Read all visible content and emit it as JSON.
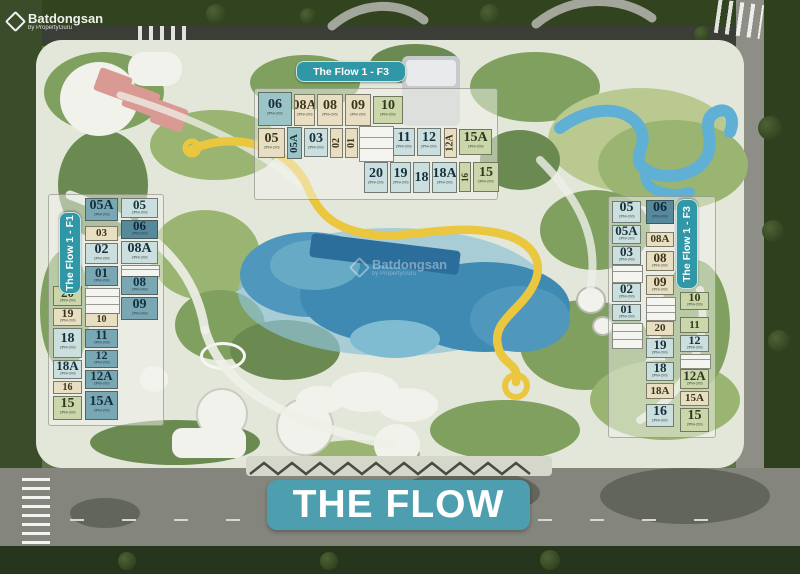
{
  "watermark": {
    "brand": "Batdongsan",
    "subtitle": "by PropertyGuru"
  },
  "banner": {
    "label": "THE FLOW"
  },
  "building_labels": {
    "top": "The Flow 1 - F3",
    "left": "The Flow 1 - F1",
    "right": "The Flow 1 - F3"
  },
  "unit_sub": "2PN+2VS",
  "colors": {
    "banner_bg": "#4d9fb0",
    "pill_bg": "#2f97a6",
    "unit_teal_dark": "#57899d",
    "unit_teal_mid": "#7aa7b4",
    "unit_teal": "#9cc3c6",
    "unit_teal_light": "#cadfde",
    "unit_cream": "#e8dfc2",
    "unit_sage": "#cbd7aa",
    "pool_blue": "#3f8ab2",
    "ribbon_yellow": "#eac73e"
  },
  "units": {
    "top": [
      {
        "n": "06",
        "x": 258,
        "y": 92,
        "w": 34,
        "h": 34,
        "c": "tl"
      },
      {
        "n": "08A",
        "x": 294,
        "y": 94,
        "w": 21,
        "h": 32,
        "c": "cr"
      },
      {
        "n": "08",
        "x": 317,
        "y": 94,
        "w": 26,
        "h": 32,
        "c": "cr"
      },
      {
        "n": "09",
        "x": 345,
        "y": 94,
        "w": 26,
        "h": 32,
        "c": "cr"
      },
      {
        "n": "10",
        "x": 373,
        "y": 96,
        "w": 30,
        "h": 28,
        "c": "sg"
      },
      {
        "n": "05",
        "x": 258,
        "y": 128,
        "w": 27,
        "h": 30,
        "c": "cr"
      },
      {
        "n": "05A",
        "x": 287,
        "y": 127,
        "w": 15,
        "h": 32,
        "c": "tl",
        "v": true
      },
      {
        "n": "03",
        "x": 304,
        "y": 128,
        "w": 24,
        "h": 29,
        "c": "lt"
      },
      {
        "n": "02",
        "x": 330,
        "y": 128,
        "w": 13,
        "h": 30,
        "c": "cr",
        "v": true
      },
      {
        "n": "01",
        "x": 345,
        "y": 128,
        "w": 13,
        "h": 30,
        "c": "cr",
        "v": true
      },
      {
        "n": "11",
        "x": 393,
        "y": 128,
        "w": 22,
        "h": 28,
        "c": "lt"
      },
      {
        "n": "12",
        "x": 417,
        "y": 128,
        "w": 24,
        "h": 28,
        "c": "lt"
      },
      {
        "n": "12A",
        "x": 444,
        "y": 128,
        "w": 13,
        "h": 30,
        "c": "cr",
        "v": true
      },
      {
        "n": "15A",
        "x": 459,
        "y": 129,
        "w": 33,
        "h": 26,
        "c": "sg"
      },
      {
        "n": "20",
        "x": 364,
        "y": 162,
        "w": 24,
        "h": 31,
        "c": "lt"
      },
      {
        "n": "19",
        "x": 390,
        "y": 162,
        "w": 21,
        "h": 31,
        "c": "lt"
      },
      {
        "n": "18",
        "x": 413,
        "y": 162,
        "w": 17,
        "h": 31,
        "c": "lt"
      },
      {
        "n": "18A",
        "x": 432,
        "y": 162,
        "w": 25,
        "h": 31,
        "c": "lt"
      },
      {
        "n": "16",
        "x": 459,
        "y": 162,
        "w": 12,
        "h": 30,
        "c": "sg",
        "v": true
      },
      {
        "n": "15",
        "x": 473,
        "y": 162,
        "w": 26,
        "h": 30,
        "c": "sg"
      }
    ],
    "left": [
      {
        "n": "20",
        "x": 53,
        "y": 286,
        "w": 29,
        "h": 20,
        "c": "sg"
      },
      {
        "n": "19",
        "x": 53,
        "y": 308,
        "w": 29,
        "h": 18,
        "c": "cr"
      },
      {
        "n": "18",
        "x": 53,
        "y": 328,
        "w": 29,
        "h": 30,
        "c": "lt"
      },
      {
        "n": "18A",
        "x": 53,
        "y": 360,
        "w": 29,
        "h": 19,
        "c": "lt"
      },
      {
        "n": "16",
        "x": 53,
        "y": 381,
        "w": 29,
        "h": 13,
        "c": "cr"
      },
      {
        "n": "15",
        "x": 53,
        "y": 396,
        "w": 29,
        "h": 24,
        "c": "sg"
      },
      {
        "n": "05A",
        "x": 85,
        "y": 198,
        "w": 33,
        "h": 23,
        "c": "t2"
      },
      {
        "n": "03",
        "x": 85,
        "y": 226,
        "w": 33,
        "h": 15,
        "c": "cr"
      },
      {
        "n": "02",
        "x": 85,
        "y": 243,
        "w": 33,
        "h": 21,
        "c": "lt"
      },
      {
        "n": "01",
        "x": 85,
        "y": 266,
        "w": 33,
        "h": 20,
        "c": "t2"
      },
      {
        "n": "10",
        "x": 85,
        "y": 313,
        "w": 33,
        "h": 14,
        "c": "cr"
      },
      {
        "n": "11",
        "x": 85,
        "y": 329,
        "w": 33,
        "h": 19,
        "c": "t2"
      },
      {
        "n": "12",
        "x": 85,
        "y": 350,
        "w": 33,
        "h": 18,
        "c": "t2"
      },
      {
        "n": "12A",
        "x": 85,
        "y": 370,
        "w": 33,
        "h": 19,
        "c": "t2"
      },
      {
        "n": "15A",
        "x": 85,
        "y": 391,
        "w": 33,
        "h": 29,
        "c": "t2"
      },
      {
        "n": "05",
        "x": 121,
        "y": 198,
        "w": 37,
        "h": 20,
        "c": "lt"
      },
      {
        "n": "06",
        "x": 121,
        "y": 220,
        "w": 37,
        "h": 19,
        "c": "dk"
      },
      {
        "n": "08A",
        "x": 121,
        "y": 241,
        "w": 37,
        "h": 23,
        "c": "lt"
      },
      {
        "n": "08",
        "x": 121,
        "y": 276,
        "w": 37,
        "h": 19,
        "c": "t2"
      },
      {
        "n": "09",
        "x": 121,
        "y": 297,
        "w": 37,
        "h": 23,
        "c": "t2"
      }
    ],
    "right": [
      {
        "n": "05",
        "x": 612,
        "y": 201,
        "w": 29,
        "h": 22,
        "c": "lt"
      },
      {
        "n": "05A",
        "x": 612,
        "y": 225,
        "w": 29,
        "h": 19,
        "c": "lt"
      },
      {
        "n": "03",
        "x": 612,
        "y": 246,
        "w": 29,
        "h": 19,
        "c": "lt"
      },
      {
        "n": "02",
        "x": 612,
        "y": 283,
        "w": 29,
        "h": 19,
        "c": "lt"
      },
      {
        "n": "01",
        "x": 612,
        "y": 304,
        "w": 29,
        "h": 17,
        "c": "lt"
      },
      {
        "n": "06",
        "x": 646,
        "y": 200,
        "w": 28,
        "h": 24,
        "c": "dk"
      },
      {
        "n": "08A",
        "x": 646,
        "y": 232,
        "w": 28,
        "h": 15,
        "c": "cr"
      },
      {
        "n": "08",
        "x": 646,
        "y": 251,
        "w": 28,
        "h": 20,
        "c": "cr"
      },
      {
        "n": "09",
        "x": 646,
        "y": 275,
        "w": 28,
        "h": 20,
        "c": "cr"
      },
      {
        "n": "20",
        "x": 646,
        "y": 321,
        "w": 28,
        "h": 15,
        "c": "cr"
      },
      {
        "n": "19",
        "x": 646,
        "y": 338,
        "w": 28,
        "h": 20,
        "c": "lt"
      },
      {
        "n": "18",
        "x": 646,
        "y": 362,
        "w": 28,
        "h": 19,
        "c": "lt"
      },
      {
        "n": "18A",
        "x": 646,
        "y": 383,
        "w": 28,
        "h": 16,
        "c": "cr"
      },
      {
        "n": "16",
        "x": 646,
        "y": 404,
        "w": 28,
        "h": 23,
        "c": "lt"
      },
      {
        "n": "10",
        "x": 680,
        "y": 292,
        "w": 29,
        "h": 18,
        "c": "sg"
      },
      {
        "n": "11",
        "x": 680,
        "y": 317,
        "w": 29,
        "h": 16,
        "c": "sg"
      },
      {
        "n": "12",
        "x": 680,
        "y": 335,
        "w": 29,
        "h": 17,
        "c": "lt"
      },
      {
        "n": "12A",
        "x": 680,
        "y": 369,
        "w": 29,
        "h": 20,
        "c": "sg"
      },
      {
        "n": "15A",
        "x": 680,
        "y": 391,
        "w": 29,
        "h": 15,
        "c": "cr"
      },
      {
        "n": "15",
        "x": 680,
        "y": 408,
        "w": 29,
        "h": 24,
        "c": "sg"
      }
    ]
  }
}
